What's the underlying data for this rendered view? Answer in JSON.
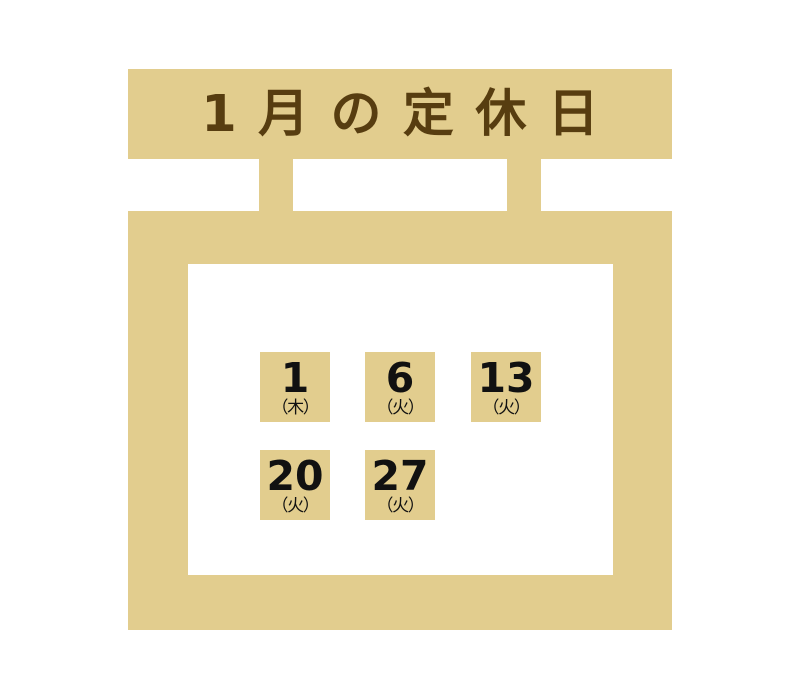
{
  "page": {
    "title": "1月の定休日"
  },
  "colors": {
    "tan": "#e2cd8e",
    "brown": "#573d10",
    "date_text": "#111111",
    "background": "#ffffff"
  },
  "calendar": {
    "holidays": [
      {
        "day": "1",
        "weekday": "（木）"
      },
      {
        "day": "6",
        "weekday": "（火）"
      },
      {
        "day": "13",
        "weekday": "（火）"
      },
      {
        "day": "20",
        "weekday": "（火）"
      },
      {
        "day": "27",
        "weekday": "（火）"
      }
    ]
  }
}
